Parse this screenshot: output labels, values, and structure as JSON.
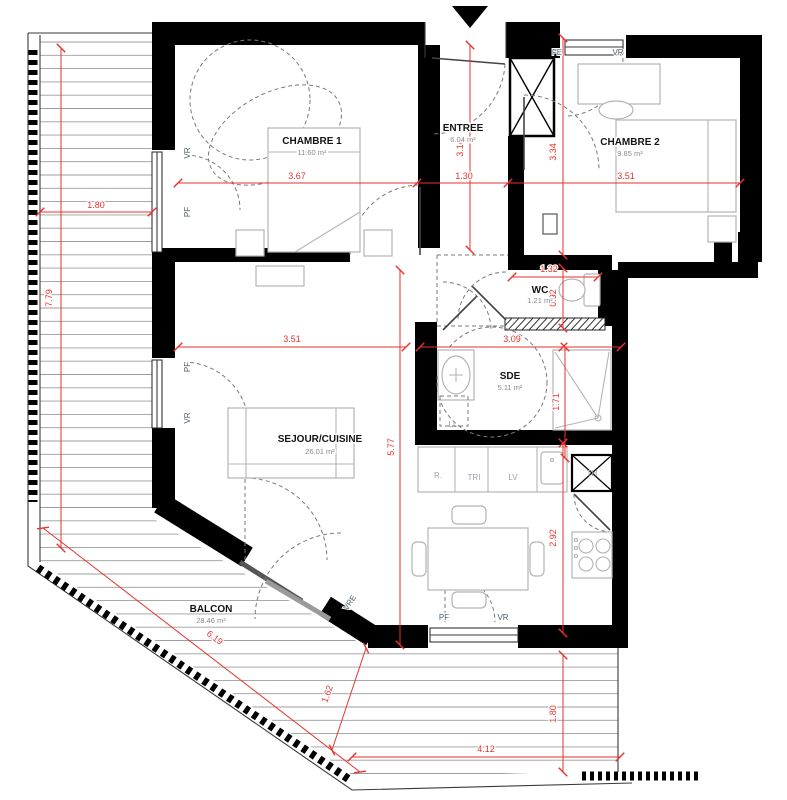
{
  "plan": {
    "rooms": {
      "chambre1": {
        "name": "CHAMBRE 1",
        "area": "11.60 m²"
      },
      "entree": {
        "name": "ENTREE",
        "area": "6.04 m²"
      },
      "chambre2": {
        "name": "CHAMBRE 2",
        "area": "9.85 m²"
      },
      "wc": {
        "name": "WC",
        "area": "1.21 m²"
      },
      "sde": {
        "name": "SDE",
        "area": "5.11 m²"
      },
      "sejour": {
        "name": "SEJOUR/CUISINE",
        "area": "26.01 m²"
      },
      "balcon": {
        "name": "BALCON",
        "area": "28.46 m²"
      }
    },
    "dimensions": {
      "balcony_left_width": "1.80",
      "balcony_left_height": "7.79",
      "chambre1_width": "3.67",
      "chambre1_height": "3.16",
      "entree_width": "1.30",
      "chambre2_width": "3.51",
      "chambre2_height": "3.34",
      "wc_width": "1.32",
      "wc_height": "0.92",
      "sejour_width": "3.51",
      "sde_width": "3.09",
      "sde_height": "1.71",
      "sejour_height": "5.77",
      "kitchen_height": "2.92",
      "balcony_diagonal": "6.19",
      "balcony_corner": "1.62",
      "balcony_bottom_width": "4.12",
      "balcony_bottom_height": "1.80"
    },
    "openings": {
      "vr": "VR",
      "pf": "PF",
      "fe": "FE",
      "vre": "VRE"
    },
    "appliances": {
      "washer": "LL",
      "fridge": "R.",
      "sorting": "TRI",
      "dishwasher": "LV",
      "water_heater": "TH"
    },
    "colors": {
      "wall": "#000000",
      "dimension": "#e8322e",
      "room_label": "#141414",
      "area_label": "#8a8a8a",
      "opening_label": "#4f5d6b",
      "furniture": "#b4b4b4",
      "deck_line": "#9c9c9c"
    }
  }
}
